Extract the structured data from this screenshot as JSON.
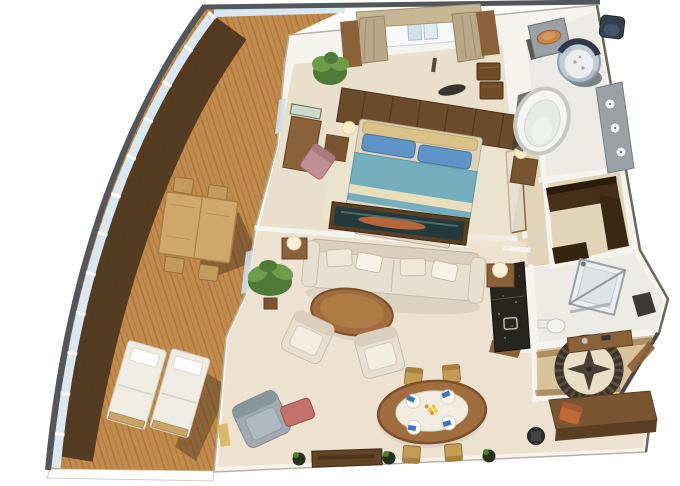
{
  "image": {
    "title": "3D isometric cutaway floor plan of a ship suite with curved private balcony"
  },
  "palette": {
    "background": "#ffffff",
    "hull_rim": "#53575b",
    "railing_glass": "#d9e7f1",
    "deck_wood": "#c28b4c",
    "deck_wood_dark": "#a8763a",
    "deck_shadow": "#4b3520",
    "wall": "#f5f3ed",
    "wall_edge": "#b8b2a5",
    "bedroom_floor": "#e9dfca",
    "living_floor": "#ece2cf",
    "closet_floor": "#e2d4b8",
    "bath_floor": "#eceae4",
    "foyer_floor": "#d9c39a",
    "wood_dark": "#5f4426",
    "wood_mid": "#8a6239",
    "wood_light": "#caa36a",
    "headboard": "#6b4b2b",
    "bed_blanket": "#74aebc",
    "bed_stripe": "#e9debc",
    "pillow_blue": "#5f94c9",
    "pillow_tan": "#d9c188",
    "upholstery_cream": "#e7dfd0",
    "armchair_gray": "#9fabb0",
    "ottoman_coral": "#c4706a",
    "chair_pink": "#c08e93",
    "dining_chair_gold": "#c49c55",
    "plant_green": "#4e7a37",
    "plant_green_light": "#6f9c4a",
    "marble_dark": "#26251f",
    "fixture_gray": "#9aa0a4",
    "shower_glass": "#b9c6d2",
    "basin_orange": "#c8874a",
    "medallion_ring": "#3b332a",
    "medallion_center": "#e9dfc6",
    "napkin_blue": "#3f74b5",
    "flower_yellow": "#e8c832",
    "painting_teal": "#23393b",
    "painting_orange": "#c96a3a",
    "curtain_tan": "#b9a888"
  },
  "scene": {
    "view": "isometric 3D cutaway render, no text labels",
    "counts": {
      "sun_loungers": 2,
      "balcony_chairs": 4,
      "dining_chairs": 4,
      "dining_place_settings": 4,
      "living_armchairs": 2
    },
    "rooms": [
      {
        "name": "balcony",
        "label": "Curved teak balcony",
        "furniture": [
          "outdoor dining table",
          "4 outdoor chairs",
          "2 sun loungers",
          "glass railing"
        ]
      },
      {
        "name": "bedroom",
        "label": "Master bedroom",
        "furniture": [
          "king bed with blue bedding",
          "headboard wall with lamps",
          "2 nightstands",
          "foot bench",
          "vanity desk with mirror",
          "pink armchair",
          "chest of drawers",
          "potted plant",
          "curtained window",
          "dark sculpture"
        ]
      },
      {
        "name": "master-bathroom",
        "label": "Master bathroom",
        "furniture": [
          "oval bathtub",
          "cylindrical glass shower",
          "vessel sink counter",
          "double vanity",
          "toilet"
        ]
      },
      {
        "name": "walk-in-closet",
        "label": "Walk-in closet",
        "furniture": [
          "L-shaped dark wardrobe",
          "low cabinet"
        ]
      },
      {
        "name": "guest-bathroom",
        "label": "Guest shower room",
        "furniture": [
          "corner glass shower",
          "toilet",
          "dark vanity"
        ]
      },
      {
        "name": "wet-bar",
        "label": "Wet bar",
        "furniture": [
          "dark marble counter with sink"
        ]
      },
      {
        "name": "living-room",
        "label": "Living room",
        "furniture": [
          "three-seat cream sofa",
          "framed abstract artwork",
          "2 cream armchairs",
          "round wood coffee table",
          "2 side tables with lamps",
          "palm plant",
          "gray armchair with coral ottoman",
          "TV console",
          "floor plants"
        ]
      },
      {
        "name": "dining-area",
        "label": "Dining area",
        "furniture": [
          "oval dining table",
          "4 place settings with blue napkins",
          "yellow flower centerpiece",
          "4 gold dining chairs"
        ]
      },
      {
        "name": "entry-foyer",
        "label": "Entry foyer",
        "furniture": [
          "compass rose floor medallion",
          "console table",
          "entry door on angled wall"
        ]
      },
      {
        "name": "office-nook",
        "label": "Desk nook",
        "furniture": [
          "wood desk",
          "orange chair",
          "dark task chair"
        ]
      }
    ]
  }
}
